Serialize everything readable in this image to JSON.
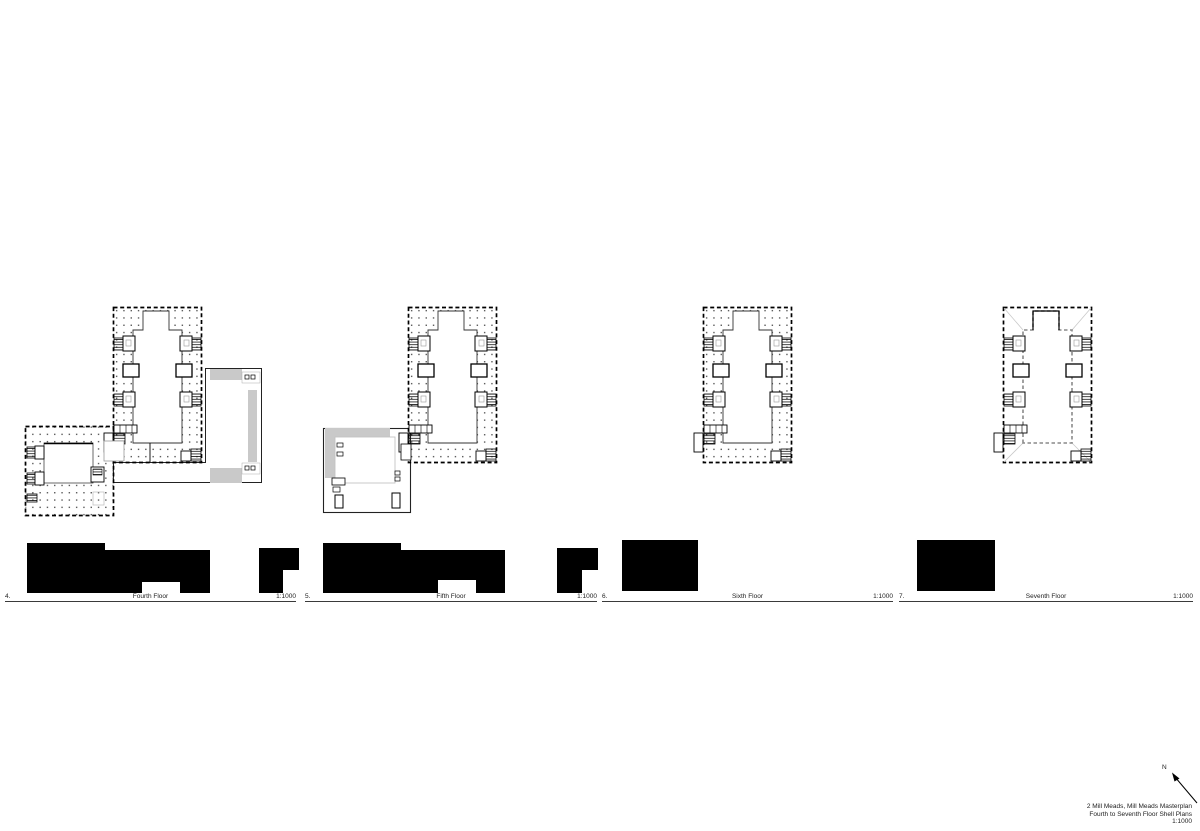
{
  "sheet": {
    "plans": [
      {
        "number": "4.",
        "label": "Fourth Floor",
        "scale": "1:1000"
      },
      {
        "number": "5.",
        "label": "Fifth Floor",
        "scale": "1:1000"
      },
      {
        "number": "6.",
        "label": "Sixth Floor",
        "scale": "1:1000"
      },
      {
        "number": "7.",
        "label": "Seventh Floor",
        "scale": "1:1000"
      }
    ],
    "title_block": {
      "project": "2 Mill Meads, Mill Meads Masterplan",
      "sheet_title": "Fourth to Seventh Floor Shell Plans",
      "scale": "1:1000",
      "north_label": "N"
    },
    "colors": {
      "ink": "#000000",
      "line_gray": "#8a8a8a",
      "fill_gray": "#c9c9c9",
      "silhouette_black": "#000000",
      "paper_white": "#ffffff"
    }
  }
}
